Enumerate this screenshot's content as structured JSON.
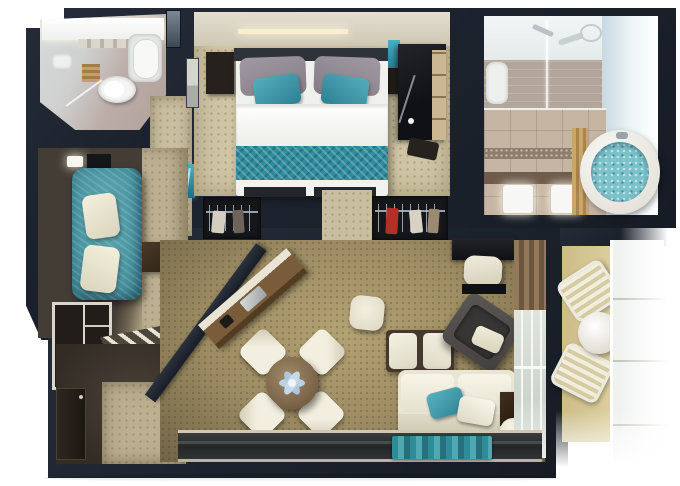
{
  "scene": {
    "kind": "top-down 3D rendered floor plan of a one-bedroom suite with balcony",
    "background": "#ffffff"
  },
  "palette": {
    "walls": "#1d232e",
    "bedroom_carpet": "#cfc5a4",
    "living_carpet": "#9e8d64",
    "corridor_carpet": "#c9bea0",
    "accent_teal": "#3f97a8",
    "bed_runner_teal": "#2f8b9e",
    "bathroom_tile": "#c6b5a2",
    "balcony_deck": "#d9ca96",
    "upholstery_cream": "#eceadb",
    "wood_dark": "#3a2c1f",
    "marble_walkway": "#2c2f30"
  },
  "rooms": {
    "guest_bathroom": {
      "label": "guest bathroom",
      "features": [
        "lit vanity counter",
        "bathtub",
        "toilet",
        "teak mat",
        "glass shower screen",
        "gray door panel"
      ]
    },
    "bedroom": {
      "label": "bedroom",
      "features": [
        "double bed",
        "gray pillows",
        "teal accent pillows",
        "white duvet",
        "teal patterned runner",
        "two nightstands",
        "headboard",
        "lit credenza wall",
        "wall art",
        "dark vanity desk",
        "teal accent panel",
        "towel shelf niche",
        "two wardrobes with hangers (red garment in right wardrobe)"
      ]
    },
    "master_bathroom": {
      "label": "master bathroom",
      "features": [
        "walk-in shower with glass partition",
        "chrome fixtures",
        "taupe tile wall",
        "twin white sinks",
        "round whirlpool tub with teal mosaic water",
        "wood tub surround",
        "mosaic floor band",
        "bright window wall"
      ]
    },
    "lounge": {
      "label": "lounge nook",
      "features": [
        "teal chaise lounge",
        "two cream pillows",
        "dark side table",
        "white shelving unit",
        "angled louvered panel",
        "small lamp"
      ]
    },
    "living_room": {
      "label": "living room",
      "features": [
        "angled bar counter with sink",
        "round dining table",
        "blue flower centerpiece",
        "four cream dining chairs",
        "cream ottoman",
        "coffee bench with two cushions",
        "dark gray armchair with cream pillow",
        "cream sofa with teal and cream pillows",
        "dark side table",
        "round stool",
        "writing desk with cream stool",
        "slatted curtain wall",
        "glass balcony door",
        "dark marble walkway",
        "teal runner rug"
      ]
    },
    "entry": {
      "label": "entry hall",
      "features": [
        "entry door",
        "dark floor",
        "beige carpet"
      ]
    },
    "balcony": {
      "label": "balcony",
      "features": [
        "two wicker chairs",
        "round white table",
        "khaki deck",
        "white glass railing"
      ]
    }
  }
}
